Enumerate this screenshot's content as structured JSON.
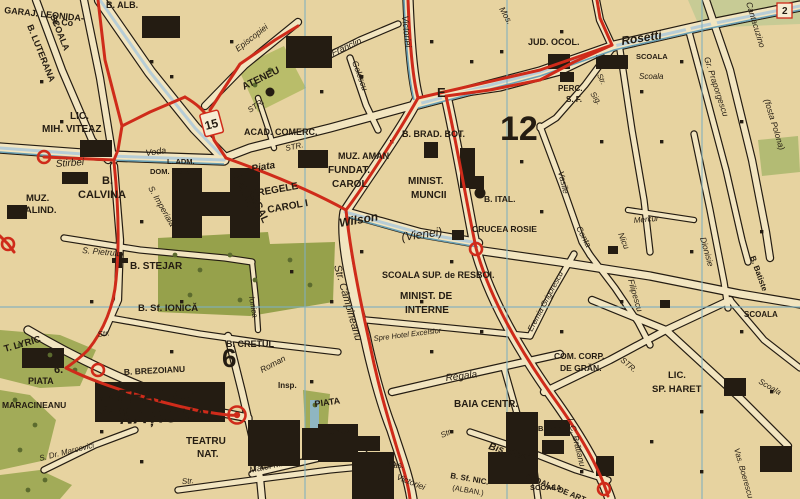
{
  "map": {
    "type": "historic-city-street-map",
    "colors": {
      "paper": "#e7d3a0",
      "street_fill": "#f2e5c0",
      "ink": "#241c12",
      "route_red": "#cf2b1a",
      "tram_blue": "#6aa0b4",
      "pale_blue_street": "#b7cdd6",
      "grid_teal": "#7fb0bf",
      "park_green": "#a2ab58",
      "park_pale": "#c7cb95",
      "district_blue": "#7f9cb8",
      "palace_label_khaki": "#cdbd8e"
    },
    "district_numbers": [
      "12",
      "6"
    ],
    "route_badges": [
      "15",
      "E",
      "2",
      "6."
    ],
    "labels": [
      {
        "t": "GARAJ. LEONIDA-",
        "x": 4,
        "y": 13,
        "r": 6,
        "fs": 9,
        "b": 1
      },
      {
        "t": "& Co",
        "x": 52,
        "y": 24,
        "r": 6,
        "fs": 9,
        "b": 1
      },
      {
        "t": "SCOALA",
        "x": 50,
        "y": 16,
        "r": 68,
        "fs": 9,
        "b": 1
      },
      {
        "t": "B. LUTERANA",
        "x": 27,
        "y": 26,
        "r": 68,
        "fs": 9,
        "b": 1
      },
      {
        "t": "B. ALB.",
        "x": 106,
        "y": 8,
        "fs": 9,
        "b": 1
      },
      {
        "t": "LIC.",
        "x": 70,
        "y": 119,
        "fs": 10,
        "b": 1
      },
      {
        "t": "MIH. VITEAZ",
        "x": 42,
        "y": 132,
        "fs": 10,
        "b": 1
      },
      {
        "t": "Stirbei",
        "x": 56,
        "y": 167,
        "r": -4,
        "fs": 10,
        "i": 1
      },
      {
        "t": "Voda",
        "x": 146,
        "y": 156,
        "r": -8,
        "fs": 9,
        "i": 1
      },
      {
        "t": "L. ADM.",
        "x": 167,
        "y": 164,
        "fs": 7.5,
        "b": 1
      },
      {
        "t": "DOM. COR.",
        "x": 150,
        "y": 174,
        "fs": 7.5,
        "b": 1
      },
      {
        "t": "S. Imperiala",
        "x": 148,
        "y": 188,
        "r": 60,
        "fs": 8.5,
        "i": 1
      },
      {
        "t": "PALAT.",
        "n": "palat-regal-label",
        "x": 234,
        "y": 176,
        "r": 66,
        "fs": 10.5,
        "b": 1,
        "c": "#cdbd8e"
      },
      {
        "t": "REGAL",
        "x": 248,
        "y": 190,
        "r": 66,
        "fs": 10.5,
        "b": 1,
        "c": "#cdbd8e"
      },
      {
        "t": "MUZ.",
        "x": 26,
        "y": 201,
        "fs": 9.5,
        "b": 1
      },
      {
        "t": "CALIND.",
        "x": 18,
        "y": 213,
        "fs": 9.5,
        "b": 1
      },
      {
        "t": "B.",
        "x": 102,
        "y": 184,
        "fs": 11,
        "b": 1
      },
      {
        "t": "CALVINA",
        "x": 78,
        "y": 198,
        "fs": 11,
        "b": 1
      },
      {
        "t": "S. Pietrului",
        "x": 82,
        "y": 253,
        "r": 5,
        "fs": 8.5,
        "i": 1
      },
      {
        "t": "B. STEJAR",
        "n": "biserica-stejar-label",
        "x": 130,
        "y": 269,
        "fs": 10,
        "b": 1
      },
      {
        "t": "B. Sf. IONICĂ",
        "x": 138,
        "y": 311,
        "fs": 9.5,
        "b": 1
      },
      {
        "t": "Ionica",
        "x": 249,
        "y": 297,
        "r": 80,
        "fs": 8,
        "i": 1
      },
      {
        "t": "B. CRETUL",
        "x": 226,
        "y": 347,
        "fs": 9,
        "b": 1
      },
      {
        "t": "T. LYRIC",
        "x": 5,
        "y": 352,
        "r": -16,
        "fs": 9.5,
        "b": 1
      },
      {
        "t": "PIATA",
        "x": 28,
        "y": 384,
        "fs": 9,
        "b": 1
      },
      {
        "t": "MARACINEANU",
        "x": 2,
        "y": 408,
        "fs": 8.5,
        "b": 1
      },
      {
        "t": "MINIST.",
        "x": 97,
        "y": 401,
        "fs": 9.5,
        "b": 1
      },
      {
        "t": "RĂZBOI",
        "x": 95,
        "y": 414,
        "fs": 9.5,
        "b": 1
      },
      {
        "t": "B. BREZOIANU",
        "x": 124,
        "y": 375,
        "r": -3,
        "fs": 8.5,
        "b": 1
      },
      {
        "t": "TEATRUL",
        "n": "teatrul-national-label",
        "x": 118,
        "y": 403,
        "r": -2,
        "fs": 19,
        "b": 1,
        "i": 1,
        "c": "#cf2b1a"
      },
      {
        "t": "NAȚIONAL",
        "x": 120,
        "y": 424,
        "r": -2,
        "fs": 19,
        "b": 1,
        "i": 1,
        "c": "#cf2b1a"
      },
      {
        "t": "TEATRU",
        "x": 186,
        "y": 444,
        "fs": 10,
        "b": 1
      },
      {
        "t": "NAT.",
        "x": 197,
        "y": 457,
        "fs": 10,
        "b": 1
      },
      {
        "t": "S. Dr. Marcovici",
        "x": 40,
        "y": 461,
        "r": -14,
        "fs": 8,
        "i": 1
      },
      {
        "t": "Str.",
        "x": 98,
        "y": 337,
        "r": -8,
        "fs": 8,
        "i": 1
      },
      {
        "t": "Matei Milo",
        "x": 250,
        "y": 473,
        "r": -12,
        "fs": 9,
        "i": 1
      },
      {
        "t": "PIATA",
        "x": 315,
        "y": 407,
        "r": -8,
        "fs": 9,
        "b": 1
      },
      {
        "t": "UNIREI",
        "x": 328,
        "y": 435,
        "r": -5,
        "fs": 9,
        "b": 1
      },
      {
        "t": "Roman",
        "x": 262,
        "y": 373,
        "r": -28,
        "fs": 8.5,
        "i": 1
      },
      {
        "t": "Insp.",
        "x": 278,
        "y": 388,
        "fs": 8,
        "b": 1
      },
      {
        "t": "Spre Hotel Excelsior",
        "x": 374,
        "y": 341,
        "r": -7,
        "fs": 7.5,
        "i": 1
      },
      {
        "t": "Regala",
        "x": 446,
        "y": 381,
        "r": -7,
        "fs": 10,
        "i": 1
      },
      {
        "t": "BAIA CENTR.",
        "n": "baia-centrala-label",
        "x": 454,
        "y": 407,
        "fs": 10,
        "b": 1
      },
      {
        "t": "Str.",
        "x": 442,
        "y": 438,
        "r": -25,
        "fs": 8,
        "i": 1
      },
      {
        "t": "Bis. Enei",
        "x": 488,
        "y": 449,
        "r": 16,
        "fs": 10,
        "b": 1,
        "i": 1
      },
      {
        "t": "B. Ene",
        "x": 538,
        "y": 431,
        "fs": 7.5,
        "b": 1
      },
      {
        "t": "B. Sf. NIC.",
        "x": 450,
        "y": 478,
        "r": 10,
        "fs": 8,
        "b": 1
      },
      {
        "t": "(ALBAN.)",
        "x": 452,
        "y": 490,
        "r": 10,
        "fs": 7.5
      },
      {
        "t": "SCOALA DE ART.",
        "x": 524,
        "y": 478,
        "r": 22,
        "fs": 8,
        "b": 1
      },
      {
        "t": "Pas.",
        "x": 388,
        "y": 468,
        "fs": 8,
        "i": 1
      },
      {
        "t": "Victoriei",
        "x": 396,
        "y": 479,
        "r": 22,
        "fs": 8.5,
        "i": 1
      },
      {
        "t": "Str. Câmpineanu",
        "x": 334,
        "y": 266,
        "r": 74,
        "fs": 10.5,
        "i": 1,
        "c": "#cf2b1a"
      },
      {
        "t": "Piata",
        "x": 252,
        "y": 172,
        "r": -10,
        "fs": 10,
        "b": 1,
        "i": 1
      },
      {
        "t": "REGELE",
        "x": 258,
        "y": 196,
        "r": -10,
        "fs": 10,
        "b": 1
      },
      {
        "t": "CAROL I",
        "x": 268,
        "y": 213,
        "r": -10,
        "fs": 10,
        "b": 1
      },
      {
        "t": "ACAD. COMERC.",
        "x": 244,
        "y": 135,
        "fs": 9,
        "b": 1
      },
      {
        "t": "STR.",
        "x": 286,
        "y": 151,
        "r": -12,
        "fs": 8,
        "i": 1
      },
      {
        "t": "Episcopiei",
        "x": 238,
        "y": 52,
        "r": -38,
        "fs": 8.5,
        "i": 1
      },
      {
        "t": "ATENEU",
        "n": "ateneu-label",
        "x": 244,
        "y": 90,
        "r": -26,
        "fs": 10,
        "b": 1
      },
      {
        "t": "STR.",
        "x": 250,
        "y": 113,
        "r": -35,
        "fs": 8,
        "i": 1
      },
      {
        "t": "Franclin",
        "x": 333,
        "y": 56,
        "r": -24,
        "fs": 9,
        "i": 1
      },
      {
        "t": "Golescu",
        "x": 352,
        "y": 62,
        "r": 70,
        "fs": 8.5,
        "i": 1
      },
      {
        "t": "Victoriei",
        "x": 402,
        "y": 16,
        "r": 84,
        "fs": 9,
        "i": 1
      },
      {
        "t": "Mos.",
        "x": 499,
        "y": 9,
        "r": 60,
        "fs": 8.5,
        "i": 1
      },
      {
        "t": "B. BRAD. BOT.",
        "x": 402,
        "y": 137,
        "fs": 9,
        "b": 1
      },
      {
        "t": "MUZ. AMAN",
        "x": 338,
        "y": 159,
        "fs": 9,
        "b": 1
      },
      {
        "t": "FUNDAT.",
        "x": 328,
        "y": 173,
        "fs": 10,
        "b": 1
      },
      {
        "t": "CAROL",
        "x": 332,
        "y": 187,
        "fs": 10,
        "b": 1
      },
      {
        "t": "MINIST.",
        "x": 408,
        "y": 184,
        "fs": 10,
        "b": 1
      },
      {
        "t": "MUNCII",
        "x": 411,
        "y": 198,
        "fs": 10,
        "b": 1
      },
      {
        "t": "B. ITAL.",
        "x": 484,
        "y": 202,
        "fs": 8.5,
        "b": 1
      },
      {
        "t": "CRUCEA ROSIE",
        "x": 472,
        "y": 232,
        "fs": 8.5,
        "b": 1
      },
      {
        "t": "Wilson",
        "x": 340,
        "y": 227,
        "r": -10,
        "fs": 12,
        "i": 1,
        "b": 1
      },
      {
        "t": "(Vienei)",
        "x": 402,
        "y": 241,
        "r": -8,
        "fs": 12,
        "i": 1
      },
      {
        "t": "SCOALA SUP. de RESBOI.",
        "x": 382,
        "y": 278,
        "fs": 9,
        "b": 1
      },
      {
        "t": "MINIST. DE",
        "x": 400,
        "y": 299,
        "fs": 10,
        "b": 1
      },
      {
        "t": "INTERNE",
        "x": 405,
        "y": 313,
        "fs": 10,
        "b": 1
      },
      {
        "t": "JUD. OCOL.",
        "x": 528,
        "y": 45,
        "fs": 9,
        "b": 1
      },
      {
        "t": "Rosetti",
        "x": 622,
        "y": 45,
        "r": -9,
        "fs": 12,
        "b": 1,
        "i": 1
      },
      {
        "t": "SCOALA",
        "x": 636,
        "y": 59,
        "fs": 7.5,
        "b": 1
      },
      {
        "t": "Scoala",
        "x": 639,
        "y": 79,
        "fs": 8,
        "i": 1
      },
      {
        "t": "Str.",
        "x": 597,
        "y": 75,
        "r": 65,
        "fs": 7.5,
        "i": 1
      },
      {
        "t": "PERC.",
        "x": 558,
        "y": 91,
        "fs": 8,
        "b": 1
      },
      {
        "t": "S. F.",
        "x": 566,
        "y": 102,
        "fs": 8,
        "b": 1
      },
      {
        "t": "Sig.",
        "x": 590,
        "y": 94,
        "r": 55,
        "fs": 8,
        "i": 1
      },
      {
        "t": "Vasile",
        "x": 558,
        "y": 172,
        "r": 76,
        "fs": 8.5,
        "i": 1
      },
      {
        "t": "Conta",
        "x": 576,
        "y": 228,
        "r": 62,
        "fs": 8.5,
        "i": 1
      },
      {
        "t": "Eremia Grigorescu",
        "x": 532,
        "y": 332,
        "r": -62,
        "fs": 8,
        "i": 1
      },
      {
        "t": "Mercur",
        "x": 634,
        "y": 223,
        "r": -5,
        "fs": 8,
        "i": 1
      },
      {
        "t": "Nicu",
        "x": 618,
        "y": 234,
        "r": 68,
        "fs": 8.5,
        "i": 1
      },
      {
        "t": "Filipescu",
        "x": 628,
        "y": 280,
        "r": 74,
        "fs": 8.5,
        "i": 1
      },
      {
        "t": "Dionisie",
        "x": 700,
        "y": 238,
        "r": 74,
        "fs": 8.5,
        "i": 1
      },
      {
        "t": "B. Batiste",
        "x": 750,
        "y": 257,
        "r": 70,
        "fs": 8,
        "b": 1
      },
      {
        "t": "SCOALA",
        "x": 744,
        "y": 317,
        "fs": 8,
        "b": 1
      },
      {
        "t": "Cantacuzino",
        "x": 746,
        "y": 3,
        "r": 73,
        "fs": 8.5,
        "i": 1
      },
      {
        "t": "(fosta Polona)",
        "x": 764,
        "y": 100,
        "r": 73,
        "fs": 8.5,
        "i": 1
      },
      {
        "t": "Gr. Praporgescu",
        "x": 704,
        "y": 58,
        "r": 72,
        "fs": 8.5,
        "i": 1
      },
      {
        "t": "COM. CORP.",
        "x": 554,
        "y": 359,
        "fs": 8.5,
        "b": 1
      },
      {
        "t": "DE GRĂN.",
        "x": 560,
        "y": 371,
        "fs": 8.5,
        "b": 1
      },
      {
        "t": "STR.",
        "x": 620,
        "y": 361,
        "r": 40,
        "fs": 8,
        "i": 1
      },
      {
        "t": "LIC.",
        "x": 668,
        "y": 378,
        "fs": 9.5,
        "b": 1
      },
      {
        "t": "SP. HARET",
        "n": "liceul-spiru-haret-label",
        "x": 652,
        "y": 392,
        "fs": 9.5,
        "b": 1
      },
      {
        "t": "Scoala",
        "x": 758,
        "y": 383,
        "r": 30,
        "fs": 8,
        "i": 1
      },
      {
        "t": "Vas. Boerescu",
        "x": 734,
        "y": 449,
        "r": 74,
        "fs": 8,
        "i": 1
      },
      {
        "t": "I. C. Brătianu",
        "x": 568,
        "y": 419,
        "r": 76,
        "fs": 8.5,
        "i": 1
      },
      {
        "t": "SCOALA",
        "x": 530,
        "y": 490,
        "fs": 7.5,
        "b": 1
      },
      {
        "t": "Str.",
        "x": 182,
        "y": 484,
        "r": -4,
        "fs": 8,
        "i": 1
      },
      {
        "t": "12",
        "n": "district-number-12",
        "x": 500,
        "y": 140,
        "fs": 34,
        "b": 1,
        "c": "#7f9cb8"
      },
      {
        "t": "6",
        "n": "district-number-6",
        "x": 222,
        "y": 367,
        "fs": 26,
        "b": 1,
        "c": "#7f9cb8"
      },
      {
        "t": "6.",
        "n": "route-badge-6",
        "x": 54,
        "y": 373,
        "fs": 11,
        "b": 1,
        "c": "#cf2b1a"
      },
      {
        "t": "15",
        "n": "route-badge-15",
        "x": 206,
        "y": 130,
        "r": -15,
        "fs": 12,
        "b": 1,
        "c": "#cf2b1a"
      },
      {
        "t": "E",
        "n": "route-badge-e",
        "x": 437,
        "y": 97,
        "fs": 13,
        "b": 1,
        "c": "#cf2b1a"
      },
      {
        "t": "2",
        "n": "route-badge-2",
        "x": 782,
        "y": 14,
        "fs": 10,
        "b": 1,
        "c": "#cf2b1a"
      }
    ]
  }
}
